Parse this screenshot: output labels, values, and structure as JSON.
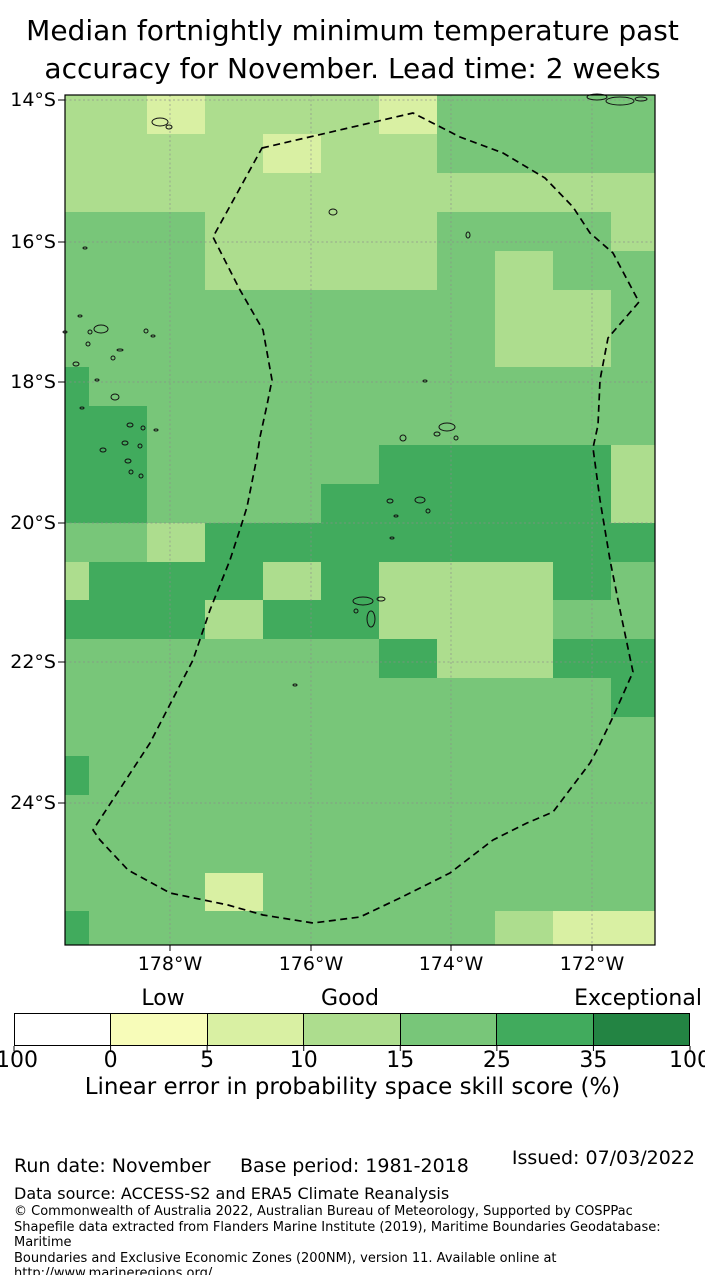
{
  "title": {
    "line1": "Median fortnightly minimum temperature past",
    "line2": "accuracy for November. Lead time: 2 weeks"
  },
  "map": {
    "lat_ticks": [
      {
        "label": "14°S",
        "y": 100
      },
      {
        "label": "16°S",
        "y": 242
      },
      {
        "label": "18°S",
        "y": 382
      },
      {
        "label": "20°S",
        "y": 523
      },
      {
        "label": "22°S",
        "y": 662
      },
      {
        "label": "24°S",
        "y": 803
      }
    ],
    "lon_ticks": [
      {
        "label": "178°W",
        "x": 170
      },
      {
        "label": "176°W",
        "x": 311
      },
      {
        "label": "174°W",
        "x": 451
      },
      {
        "label": "172°W",
        "x": 592
      }
    ],
    "grid": {
      "col_edges": [
        65,
        89,
        147,
        205,
        263,
        321,
        379,
        437,
        495,
        553,
        611,
        655
      ],
      "row_edges": [
        95,
        134,
        173,
        212,
        251,
        290,
        328,
        367,
        406,
        445,
        484,
        523,
        562,
        600,
        639,
        678,
        717,
        756,
        795,
        834,
        873,
        911,
        945
      ],
      "palette": {
        "Y": "#f7fcb9",
        "P": "#d9f0a3",
        "L": "#addd8e",
        "M": "#78c679",
        "D": "#41ab5d"
      },
      "rows": [
        "LLPLLLPMMMM",
        "LLLLPLLMMMM",
        "LLLLLLLLLLL",
        "MMMLLLLMMML",
        "MMMLLLLMLMM",
        "MMMMMMMMLLM",
        "MMMMMMMMLLM",
        "DMMMMMMMMMM",
        "DDMMMMMMMMM",
        "DDMMMMDDDDL",
        "DDMMMDDDDDL",
        "MMLDDDDDDDD",
        "LDDDLDLLLDM",
        "DDDLDDLLLMM",
        "MMMMMMDLLDD",
        "MMMMMMMMMMD",
        "MMMMMMMMMMM",
        "DMMMMMMMMMM",
        "MMMMMMMMMMM",
        "MMMMMMMMMMM",
        "MMMPMMMMMMM",
        "DMMMMMMMLPP"
      ]
    },
    "eez_boundary": {
      "style": "dashed",
      "points": [
        [
          262,
          148
        ],
        [
          413,
          113
        ],
        [
          460,
          137
        ],
        [
          503,
          153
        ],
        [
          545,
          178
        ],
        [
          573,
          207
        ],
        [
          590,
          233
        ],
        [
          613,
          253
        ],
        [
          639,
          302
        ],
        [
          608,
          338
        ],
        [
          600,
          380
        ],
        [
          598,
          425
        ],
        [
          593,
          448
        ],
        [
          600,
          500
        ],
        [
          610,
          560
        ],
        [
          620,
          610
        ],
        [
          633,
          672
        ],
        [
          613,
          717
        ],
        [
          597,
          750
        ],
        [
          590,
          763
        ],
        [
          553,
          812
        ],
        [
          527,
          823
        ],
        [
          493,
          840
        ],
        [
          450,
          873
        ],
        [
          400,
          898
        ],
        [
          360,
          917
        ],
        [
          313,
          923
        ],
        [
          263,
          915
        ],
        [
          228,
          905
        ],
        [
          170,
          893
        ],
        [
          128,
          870
        ],
        [
          100,
          840
        ],
        [
          93,
          830
        ],
        [
          150,
          743
        ],
        [
          193,
          660
        ],
        [
          210,
          610
        ],
        [
          230,
          560
        ],
        [
          242,
          523
        ],
        [
          247,
          507
        ],
        [
          257,
          457
        ],
        [
          260,
          437
        ],
        [
          267,
          405
        ],
        [
          272,
          380
        ],
        [
          263,
          330
        ],
        [
          240,
          290
        ],
        [
          213,
          237
        ]
      ]
    },
    "islands": [
      [
        160,
        122,
        8,
        4
      ],
      [
        169,
        127,
        3,
        2
      ],
      [
        597,
        97,
        10,
        3
      ],
      [
        620,
        101,
        14,
        4
      ],
      [
        641,
        99,
        6,
        2
      ],
      [
        333,
        212,
        4,
        3
      ],
      [
        468,
        235,
        2,
        3
      ],
      [
        425,
        381,
        2,
        1
      ],
      [
        85,
        248,
        2,
        1
      ],
      [
        80,
        316,
        2,
        1
      ],
      [
        65,
        332,
        2,
        1
      ],
      [
        101,
        329,
        7,
        4
      ],
      [
        90,
        332,
        2,
        2
      ],
      [
        146,
        331,
        2,
        2
      ],
      [
        153,
        336,
        2,
        1
      ],
      [
        88,
        344,
        2,
        2
      ],
      [
        120,
        350,
        3,
        1
      ],
      [
        113,
        358,
        2,
        2
      ],
      [
        76,
        364,
        3,
        2
      ],
      [
        97,
        380,
        2,
        1
      ],
      [
        115,
        397,
        4,
        3
      ],
      [
        82,
        408,
        2,
        1
      ],
      [
        130,
        425,
        3,
        2
      ],
      [
        143,
        428,
        2,
        2
      ],
      [
        156,
        430,
        2,
        1
      ],
      [
        125,
        443,
        3,
        2
      ],
      [
        140,
        446,
        2,
        2
      ],
      [
        103,
        450,
        3,
        2
      ],
      [
        128,
        461,
        3,
        2
      ],
      [
        131,
        472,
        2,
        2
      ],
      [
        141,
        476,
        2,
        2
      ],
      [
        447,
        427,
        8,
        4
      ],
      [
        437,
        434,
        3,
        2
      ],
      [
        456,
        438,
        2,
        2
      ],
      [
        403,
        438,
        3,
        3
      ],
      [
        420,
        500,
        5,
        3
      ],
      [
        390,
        501,
        3,
        2
      ],
      [
        428,
        511,
        2,
        2
      ],
      [
        396,
        516,
        2,
        1
      ],
      [
        392,
        538,
        2,
        1
      ],
      [
        363,
        601,
        10,
        4
      ],
      [
        381,
        599,
        4,
        2
      ],
      [
        371,
        619,
        4,
        8
      ],
      [
        356,
        611,
        2,
        2
      ],
      [
        295,
        685,
        2,
        1
      ]
    ]
  },
  "colorbar": {
    "zone_labels": [
      {
        "text": "Low"
      },
      {
        "text": "Good"
      },
      {
        "text": "Exceptional"
      }
    ],
    "colors": [
      "#ffffff",
      "#f7fcb9",
      "#d9f0a3",
      "#addd8e",
      "#78c679",
      "#41ab5d",
      "#238443"
    ],
    "tick_labels": [
      "100",
      "0",
      "5",
      "10",
      "15",
      "25",
      "35",
      "100"
    ],
    "caption": "Linear error in probability space skill score (%)"
  },
  "footer": {
    "run_date": "Run date: November",
    "base_period": "Base period: 1981-2018",
    "issued": "Issued: 07/03/2022",
    "data_source": "Data source: ACCESS-S2 and ERA5 Climate Reanalysis",
    "copyright_lines": [
      "© Commonwealth of Australia 2022, Australian Bureau of Meteorology, Supported by COSPPac",
      "Shapefile data extracted from Flanders Marine Institute (2019), Maritime Boundaries Geodatabase: Maritime",
      "Boundaries and Exclusive Economic Zones (200NM), version 11. Available online at",
      "http://www.marineregions.org/."
    ]
  }
}
